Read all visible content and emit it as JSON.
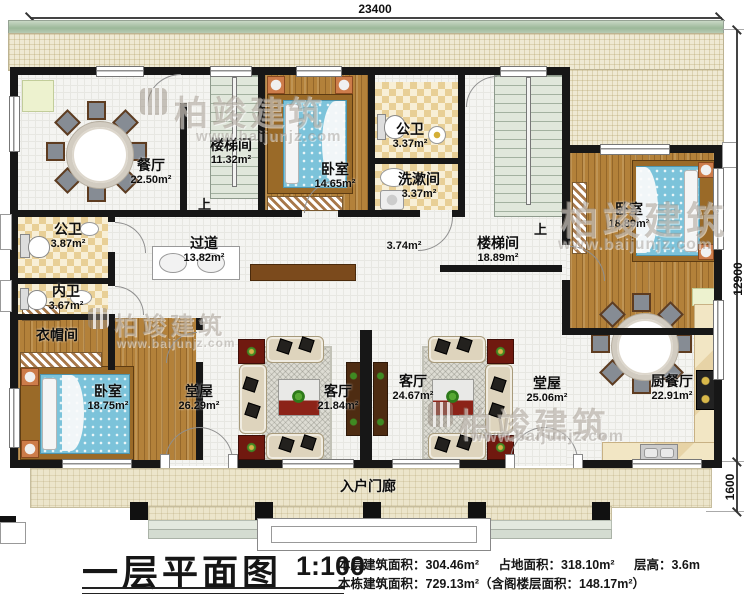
{
  "dimensions": {
    "top": "23400",
    "right_main": "12900",
    "right_porch": "1600"
  },
  "watermark": {
    "brand": "柏竣建筑",
    "url": "www.baijunjz.com",
    "icon": "building-logo-icon"
  },
  "colors": {
    "wall": "#171717",
    "wood_floor": "#b3813a",
    "bed_blue": "#7cc3da",
    "bath_checker": "#e8cf96",
    "stair_sage": "#e0e7db",
    "terrace": "#efe9d3",
    "accent_red": "#8c2318"
  },
  "rooms": {
    "dining": {
      "name": "餐厅",
      "area": "22.50m²"
    },
    "stair1": {
      "name": "楼梯间",
      "area": "11.32m²"
    },
    "bedroom2": {
      "name": "卧室",
      "area": "14.65m²"
    },
    "bath2": {
      "name": "公卫",
      "area": "3.37m²"
    },
    "washroom": {
      "name": "洗漱间",
      "area": "3.37m²"
    },
    "bedroom3": {
      "name": "卧室",
      "area": "18.89m²"
    },
    "bath1": {
      "name": "公卫",
      "area": "3.87m²"
    },
    "hallway": {
      "name": "过道",
      "area": "13.82m²"
    },
    "passage": {
      "area": "3.74m²"
    },
    "stair2": {
      "name": "楼梯间",
      "area": "18.89m²"
    },
    "ensuite": {
      "name": "内卫",
      "area": "3.67m²"
    },
    "cloak": {
      "name": "衣帽间"
    },
    "bedroom1": {
      "name": "卧室",
      "area": "18.75m²"
    },
    "hall1": {
      "name": "堂屋",
      "area": "26.29m²"
    },
    "living1": {
      "name": "客厅",
      "area": "21.84m²"
    },
    "living2": {
      "name": "客厅",
      "area": "24.67m²"
    },
    "hall2": {
      "name": "堂屋",
      "area": "25.06m²"
    },
    "kitchen": {
      "name": "厨餐厅",
      "area": "22.91m²"
    },
    "porch": {
      "name": "入户门廊"
    }
  },
  "stairs": {
    "up": "上"
  },
  "footer": {
    "title": "一层平面图",
    "scale": "1:100",
    "stat1": "本层建筑面积：304.46m²",
    "stat2": "占地面积：318.10m²",
    "stat3": "层高：3.6m",
    "stat4": "本栋建筑面积：729.13m²（含阁楼层面积：148.17m²）"
  }
}
